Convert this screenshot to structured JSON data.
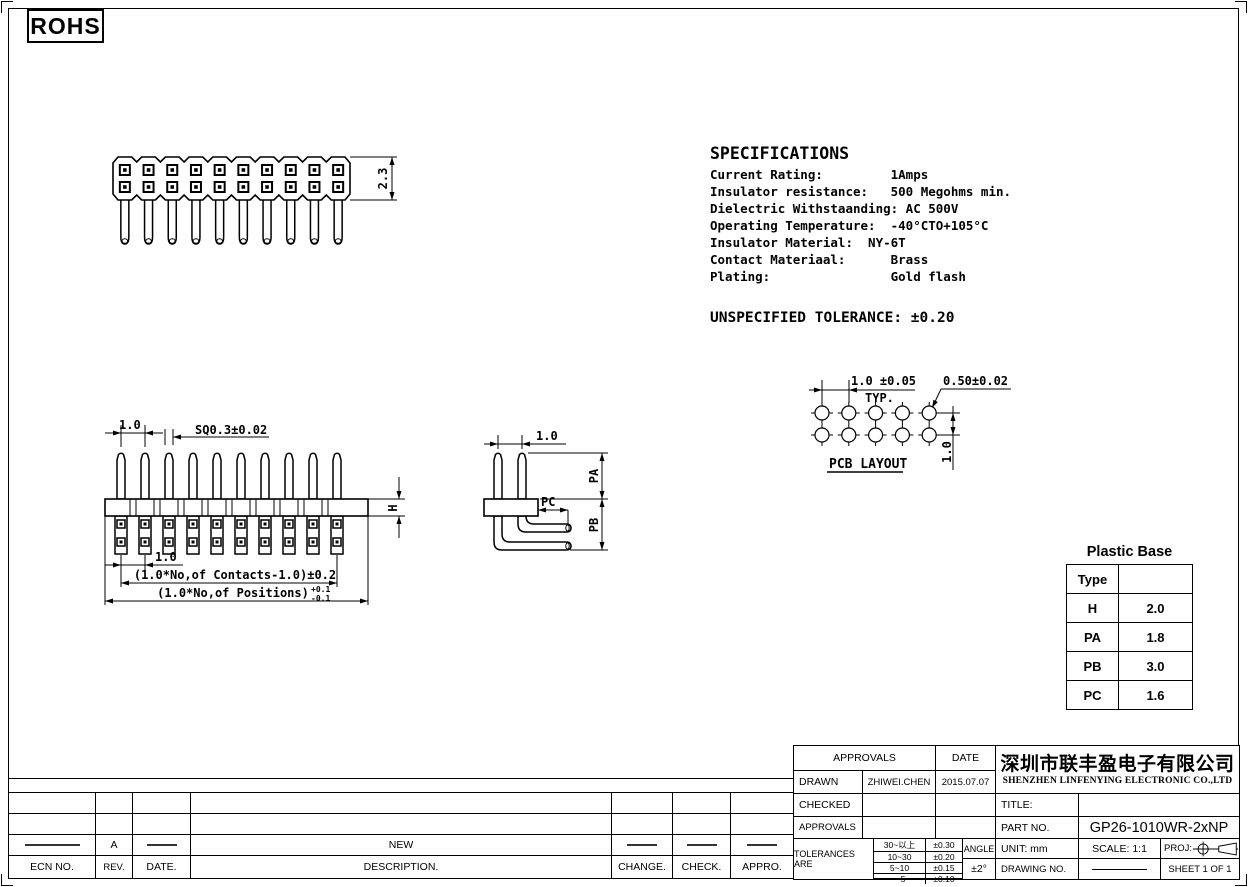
{
  "rohs_label": "ROHS",
  "specifications": {
    "title": "SPECIFICATIONS",
    "lines": [
      "Current Rating:         1Amps",
      "Insulator resistance:   500 Megohms min.",
      "Dielectric Withstaanding: AC 500V",
      "Operating Temperature:  -40°CTO+105°C",
      "Insulator Material:  NY-6T",
      "Contact Materiaal:      Brass",
      "Plating:                Gold flash"
    ],
    "unspecified_tolerance": "UNSPECIFIED TOLERANCE: ±0.20"
  },
  "views": {
    "top_view": {
      "positions": 10,
      "hole_rows": 2,
      "dim_body_height": "2.3"
    },
    "front_view": {
      "positions": 10,
      "dim_pitch_top": "1.0",
      "dim_pin_square": "SQ0.3±0.02",
      "dim_base_height": "H",
      "dim_pitch_bottom": "1.0",
      "dim_contacts": "(1.0*No,of Contacts-1.0)±0.2",
      "dim_positions": "(1.0*No,of Positions)",
      "dim_positions_tol_upper": "+0.1",
      "dim_positions_tol_lower": "-0.1"
    },
    "side_view": {
      "dim_row_pitch": "1.0",
      "dim_pa": "PA",
      "dim_pb": "PB",
      "dim_pc": "PC"
    },
    "pcb_layout": {
      "title": "PCB LAYOUT",
      "hole_cols": 5,
      "hole_rows": 2,
      "dim_pitch": "1.0 ±0.05",
      "dim_pitch_note": "TYP.",
      "dim_hole_dia": "0.50±0.02",
      "dim_row_pitch": "1.0"
    }
  },
  "plastic_base": {
    "title": "Plastic Base",
    "rows": [
      {
        "param": "Type",
        "value": ""
      },
      {
        "param": "H",
        "value": "2.0"
      },
      {
        "param": "PA",
        "value": "1.8"
      },
      {
        "param": "PB",
        "value": "3.0"
      },
      {
        "param": "PC",
        "value": "1.6"
      }
    ]
  },
  "title_block": {
    "approvals_header": "APPROVALS",
    "date_header": "DATE",
    "drawn_label": "DRAWN",
    "drawn_by": "ZHIWEI.CHEN",
    "drawn_date": "2015.07.07",
    "checked_label": "CHECKED",
    "approvals_label": "APPROVALS",
    "tolerances_label": "TOLERANCES ARE",
    "tolerance_rows": [
      {
        "range": "30~以上",
        "value": "±0.30"
      },
      {
        "range": "10~30",
        "value": "±0.20"
      },
      {
        "range": "5~10",
        "value": "±0.15"
      },
      {
        "range": "~ 5",
        "value": "±0.10"
      }
    ],
    "angle_label": "ANGLE",
    "angle_value": "±2°",
    "company_cn": "深圳市联丰盈电子有限公司",
    "company_en": "SHENZHEN LINFENYING ELECTRONIC CO.,LTD",
    "title_label": "TITLE:",
    "part_no_label": "PART  NO.",
    "part_no": "GP26-1010WR-2xNP",
    "unit_label": "UNIT:  mm",
    "scale_label": "SCALE:   1:1",
    "proj_label": "PROJ:",
    "drawing_no_label": "DRAWING  NO.",
    "sheet_label": "SHEET   1  OF  1"
  },
  "revision": {
    "headers": [
      "ECN  NO.",
      "REV.",
      "DATE.",
      "DESCRIPTION.",
      "CHANGE.",
      "CHECK.",
      "APPRO."
    ],
    "rev_value": "A",
    "description_value": "NEW"
  }
}
